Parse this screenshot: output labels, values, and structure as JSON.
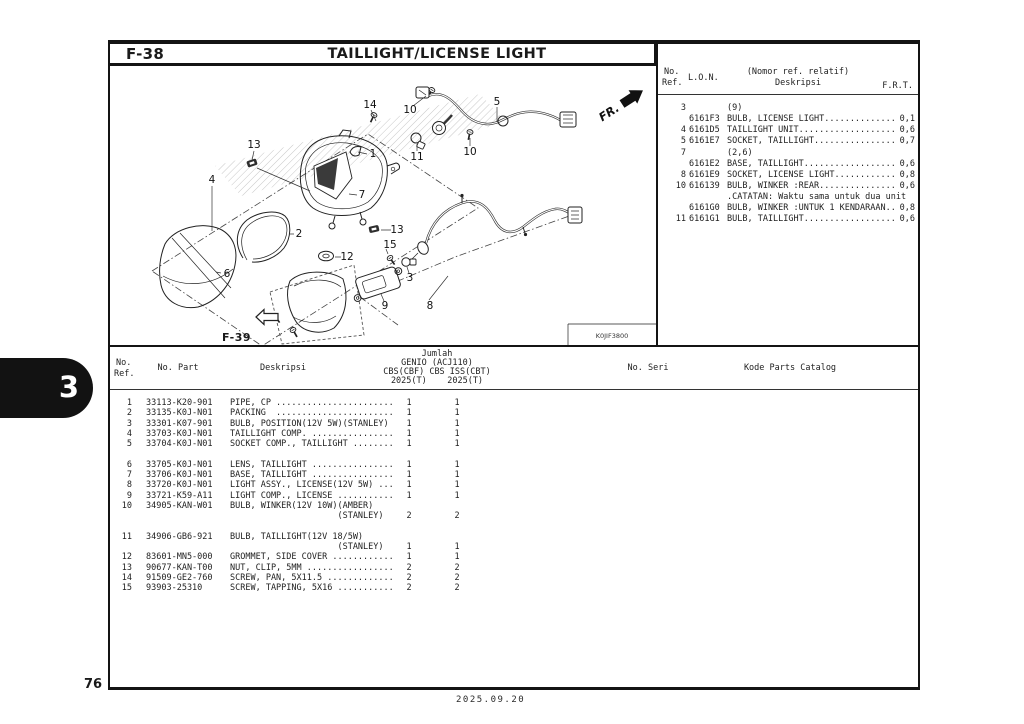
{
  "colors": {
    "ink": "#1a1a1a",
    "tab_bg": "#121212",
    "hatch": "#aaaaaa"
  },
  "page": {
    "code": "F-38",
    "title": "TAILLIGHT/LICENSE LIGHT",
    "section_tab": "3",
    "page_number": "76",
    "date": "2025.09.20"
  },
  "diagram": {
    "code": "K0JIF3800",
    "fr_label": "FR.",
    "ref_link": "F-39",
    "callouts": [
      {
        "label": "14",
        "x": 260,
        "y": 39
      },
      {
        "label": "10",
        "x": 300,
        "y": 44
      },
      {
        "label": "5",
        "x": 387,
        "y": 36
      },
      {
        "label": "11",
        "x": 307,
        "y": 91
      },
      {
        "label": "10",
        "x": 360,
        "y": 86
      },
      {
        "label": "13",
        "x": 144,
        "y": 79
      },
      {
        "label": "1",
        "x": 263,
        "y": 88
      },
      {
        "label": "4",
        "x": 102,
        "y": 114
      },
      {
        "label": "7",
        "x": 252,
        "y": 129
      },
      {
        "label": "2",
        "x": 189,
        "y": 168
      },
      {
        "label": "13",
        "x": 287,
        "y": 164
      },
      {
        "label": "15",
        "x": 280,
        "y": 179
      },
      {
        "label": "12",
        "x": 237,
        "y": 191
      },
      {
        "label": "3",
        "x": 300,
        "y": 212
      },
      {
        "label": "6",
        "x": 117,
        "y": 208
      },
      {
        "label": "9",
        "x": 275,
        "y": 240
      },
      {
        "label": "8",
        "x": 320,
        "y": 240
      }
    ]
  },
  "ref_table": {
    "header": {
      "no": "No.",
      "ref": "Ref.",
      "lon": "L.O.N.",
      "relative_note": "(Nomor ref. relatif)",
      "deskripsi": "Deskripsi",
      "frt": "F.R.T."
    },
    "rows": [
      {
        "ref": "3",
        "lon": "",
        "desc": "(9)",
        "frt": ""
      },
      {
        "ref": "",
        "lon": "6161F3",
        "desc": "BULB, LICENSE LIGHT..............",
        "frt": "0,1"
      },
      {
        "ref": "4",
        "lon": "6161D5",
        "desc": "TAILLIGHT UNIT...................",
        "frt": "0,6"
      },
      {
        "ref": "5",
        "lon": "6161E7",
        "desc": "SOCKET, TAILLIGHT................",
        "frt": "0,7"
      },
      {
        "ref": "7",
        "lon": "",
        "desc": "(2,6)",
        "frt": ""
      },
      {
        "ref": "",
        "lon": "6161E2",
        "desc": "BASE, TAILLIGHT..................",
        "frt": "0,6"
      },
      {
        "ref": "8",
        "lon": "6161E9",
        "desc": "SOCKET, LICENSE LIGHT............",
        "frt": "0,8"
      },
      {
        "ref": "10",
        "lon": "616139",
        "desc": "BULB, WINKER :REAR...............",
        "frt": "0,6"
      },
      {
        "ref": "",
        "lon": "",
        "desc": ".CATATAN: Waktu sama untuk dua unit",
        "frt": ""
      },
      {
        "ref": "",
        "lon": "6161G0",
        "desc": "BULB, WINKER :UNTUK 1 KENDARAAN..",
        "frt": "0,8"
      },
      {
        "ref": "11",
        "lon": "6161G1",
        "desc": "BULB, TAILLIGHT..................",
        "frt": "0,6"
      }
    ]
  },
  "parts_table": {
    "header": {
      "no": "No.",
      "ref": "Ref.",
      "part": "No. Part",
      "deskripsi": "Deskripsi",
      "jumlah": "Jumlah",
      "model": "GENIO (ACJ110)",
      "variant": "CBS(CBF) CBS ISS(CBT)",
      "years": "2025(T)    2025(T)",
      "seri": "No. Seri",
      "kode": "Kode Parts Catalog"
    },
    "rows": [
      {
        "ref": "1",
        "part": "33113-K20-901",
        "desc": "PIPE, CP .......................",
        "q1": "1",
        "q2": "1"
      },
      {
        "ref": "2",
        "part": "33135-K0J-N01",
        "desc": "PACKING  .......................",
        "q1": "1",
        "q2": "1"
      },
      {
        "ref": "3",
        "part": "33301-K07-901",
        "desc": "BULB, POSITION(12V 5W)(STANLEY)",
        "q1": "1",
        "q2": "1"
      },
      {
        "ref": "4",
        "part": "33703-K0J-N01",
        "desc": "TAILLIGHT COMP. ................",
        "q1": "1",
        "q2": "1"
      },
      {
        "ref": "5",
        "part": "33704-K0J-N01",
        "desc": "SOCKET COMP., TAILLIGHT ........",
        "q1": "1",
        "q2": "1"
      },
      {
        "ref": "",
        "part": "",
        "desc": "",
        "q1": "",
        "q2": ""
      },
      {
        "ref": "6",
        "part": "33705-K0J-N01",
        "desc": "LENS, TAILLIGHT ................",
        "q1": "1",
        "q2": "1"
      },
      {
        "ref": "7",
        "part": "33706-K0J-N01",
        "desc": "BASE, TAILLIGHT ................",
        "q1": "1",
        "q2": "1"
      },
      {
        "ref": "8",
        "part": "33720-K0J-N01",
        "desc": "LIGHT ASSY., LICENSE(12V 5W) ...",
        "q1": "1",
        "q2": "1"
      },
      {
        "ref": "9",
        "part": "33721-K59-A11",
        "desc": "LIGHT COMP., LICENSE ...........",
        "q1": "1",
        "q2": "1"
      },
      {
        "ref": "10",
        "part": "34905-KAN-W01",
        "desc": "BULB, WINKER(12V 10W)(AMBER)",
        "q1": "",
        "q2": ""
      },
      {
        "ref": "",
        "part": "",
        "desc": "                     (STANLEY)",
        "q1": "2",
        "q2": "2"
      },
      {
        "ref": "",
        "part": "",
        "desc": "",
        "q1": "",
        "q2": ""
      },
      {
        "ref": "11",
        "part": "34906-GB6-921",
        "desc": "BULB, TAILLIGHT(12V 18/5W)",
        "q1": "",
        "q2": ""
      },
      {
        "ref": "",
        "part": "",
        "desc": "                     (STANLEY)",
        "q1": "1",
        "q2": "1"
      },
      {
        "ref": "12",
        "part": "83601-MN5-000",
        "desc": "GROMMET, SIDE COVER ............",
        "q1": "1",
        "q2": "1"
      },
      {
        "ref": "13",
        "part": "90677-KAN-T00",
        "desc": "NUT, CLIP, 5MM .................",
        "q1": "2",
        "q2": "2"
      },
      {
        "ref": "14",
        "part": "91509-GE2-760",
        "desc": "SCREW, PAN, 5X11.5 .............",
        "q1": "2",
        "q2": "2"
      },
      {
        "ref": "15",
        "part": "93903-25310",
        "desc": "SCREW, TAPPING, 5X16 ...........",
        "q1": "2",
        "q2": "2"
      }
    ]
  }
}
